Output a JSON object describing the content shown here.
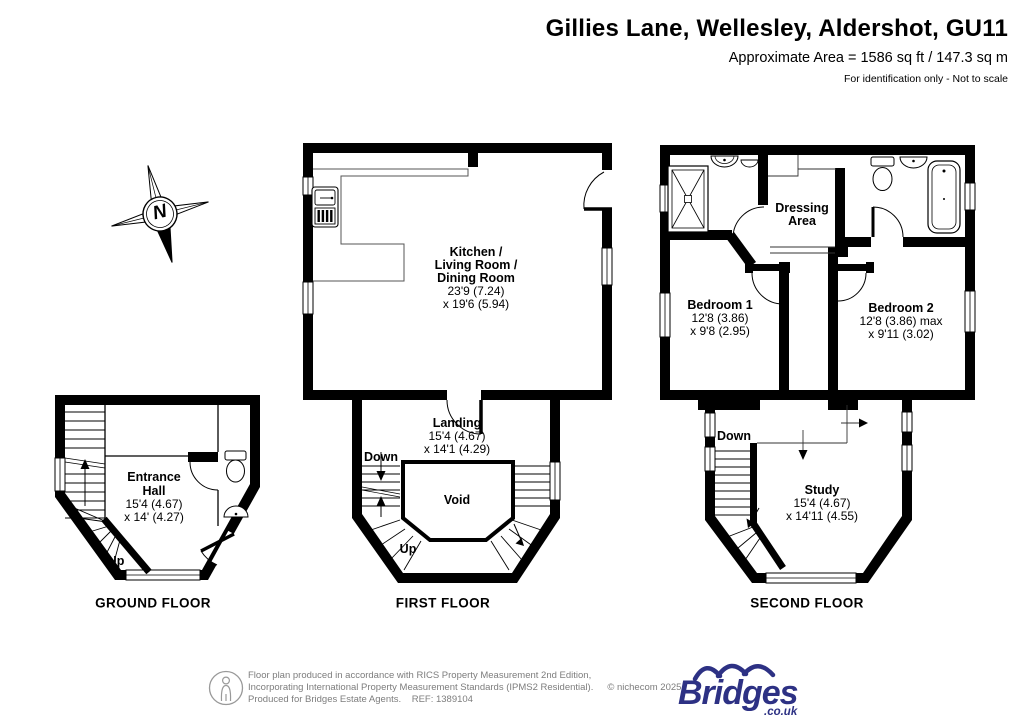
{
  "header": {
    "title": "Gillies Lane, Wellesley, Aldershot, GU11",
    "subtitle": "Approximate Area = 1586 sq ft / 147.3 sq m",
    "note": "For identification only - Not to scale"
  },
  "compass": {
    "n": "N"
  },
  "ground_floor": {
    "label": "GROUND FLOOR",
    "entrance_hall": {
      "line1": "Entrance",
      "line2": "Hall",
      "dim1": "15'4 (4.67)",
      "dim2": "x 14' (4.27)"
    },
    "up": "Up"
  },
  "first_floor": {
    "label": "FIRST FLOOR",
    "kitchen": {
      "line1": "Kitchen /",
      "line2": "Living Room /",
      "line3": "Dining Room",
      "dim1": "23'9 (7.24)",
      "dim2": "x 19'6 (5.94)"
    },
    "landing": {
      "name": "Landing",
      "dim1": "15'4 (4.67)",
      "dim2": "x 14'1 (4.29)"
    },
    "void": "Void",
    "down": "Down",
    "up": "Up"
  },
  "second_floor": {
    "label": "SECOND FLOOR",
    "bedroom1": {
      "name": "Bedroom 1",
      "dim1": "12'8 (3.86)",
      "dim2": "x 9'8 (2.95)"
    },
    "bedroom2": {
      "name": "Bedroom 2",
      "dim1": "12'8 (3.86) max",
      "dim2": "x 9'11 (3.02)"
    },
    "dressing_area": {
      "line1": "Dressing",
      "line2": "Area"
    },
    "study": {
      "name": "Study",
      "dim1": "15'4 (4.67)",
      "dim2": "x 14'11 (4.55)"
    },
    "down": "Down"
  },
  "footer": {
    "line1": "Floor plan produced in accordance with RICS Property Measurement 2nd Edition,",
    "line2": "Incorporating International Property Measurement Standards (IPMS2 Residential).",
    "copyright": "© nichecom 2025.",
    "line3": "Produced for Bridges Estate Agents.    REF: 1389104",
    "logo_text": "Bridges",
    "logo_suffix": ".co.uk"
  },
  "colors": {
    "walls": "#000000",
    "logo_navy": "#2d3184",
    "footer_gray": "#7d7d7d"
  }
}
